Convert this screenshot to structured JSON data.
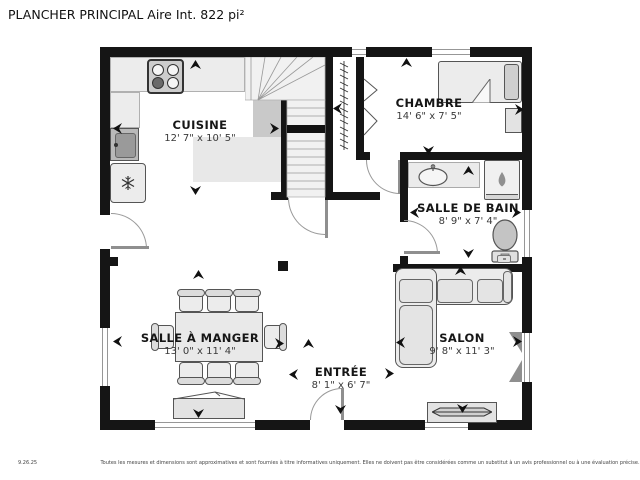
{
  "title": "PLANCHER PRINCIPAL Aire Int. 822 pi²",
  "rooms": {
    "cuisine": {
      "name": "CUISINE",
      "dims": "12' 7\" x 10' 5\""
    },
    "chambre": {
      "name": "CHAMBRE",
      "dims": "14' 6\" x 7' 5\""
    },
    "salle_de_bain": {
      "name": "SALLE DE BAIN",
      "dims": "8' 9\" x 7' 4\""
    },
    "salle_a_manger": {
      "name": "SALLE À MANGER",
      "dims": "13' 0\" x 11' 4\""
    },
    "salon": {
      "name": "SALON",
      "dims": "9' 8\" x 11' 3\""
    },
    "entree": {
      "name": "ENTRÉE",
      "dims": "8' 1\" x 6' 7\""
    }
  },
  "footer": {
    "date": "9.26.25",
    "disclaimer": "Toutes les mesures et dimensions sont approximatives et sont fournies à titre informatives uniquement. Elles ne doivent pas être considérées comme un substitut à un avis professionnel ou à une évaluation précise."
  },
  "colors": {
    "wall": "#151515",
    "furniture_fill": "#ececec",
    "furniture_line": "#555555",
    "shade_light": "#e8e8e8",
    "shade_dark": "#c9c9c9",
    "text": "#161616"
  }
}
